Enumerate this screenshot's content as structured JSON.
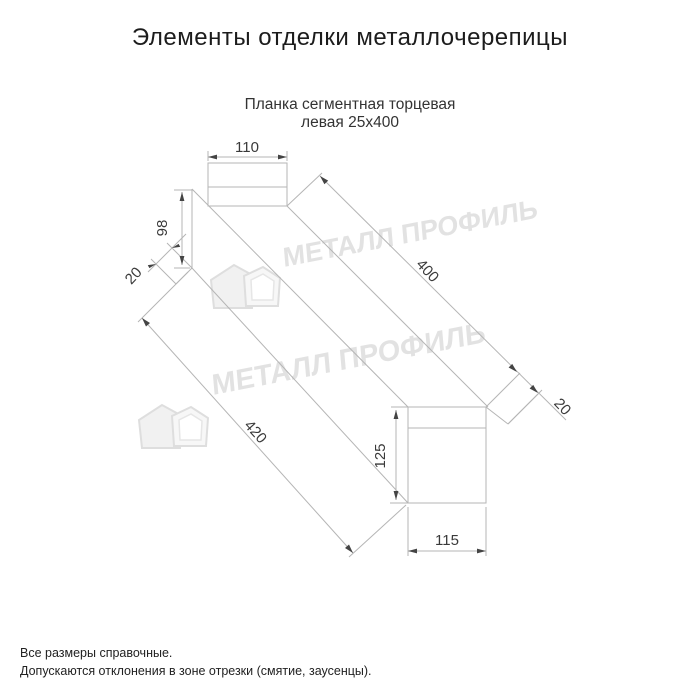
{
  "page": {
    "title": "Элементы отделки металлочерепицы"
  },
  "product": {
    "subtitle_line1": "Планка сегментная торцевая",
    "subtitle_line2": "левая 25х400"
  },
  "dimensions": {
    "top_flange_width": "110",
    "left_end_height": "98",
    "left_fold": "20",
    "top_edge_length": "400",
    "right_fold": "20",
    "bottom_edge_length": "420",
    "right_end_height": "125",
    "bottom_flange_width": "115"
  },
  "watermark": {
    "text": "МЕТАЛЛ ПРОФИЛЬ",
    "logo_icon": "house-roof-logo-icon",
    "color": "#e2e2e2"
  },
  "drawing": {
    "line_color": "#b5b5b5",
    "arrow_color": "#444444",
    "text_color": "#3a3a3a"
  },
  "footer": {
    "note1": "Все размеры справочные.",
    "note2": "Допускаются отклонения в зоне отрезки (смятие, заусенцы)."
  }
}
